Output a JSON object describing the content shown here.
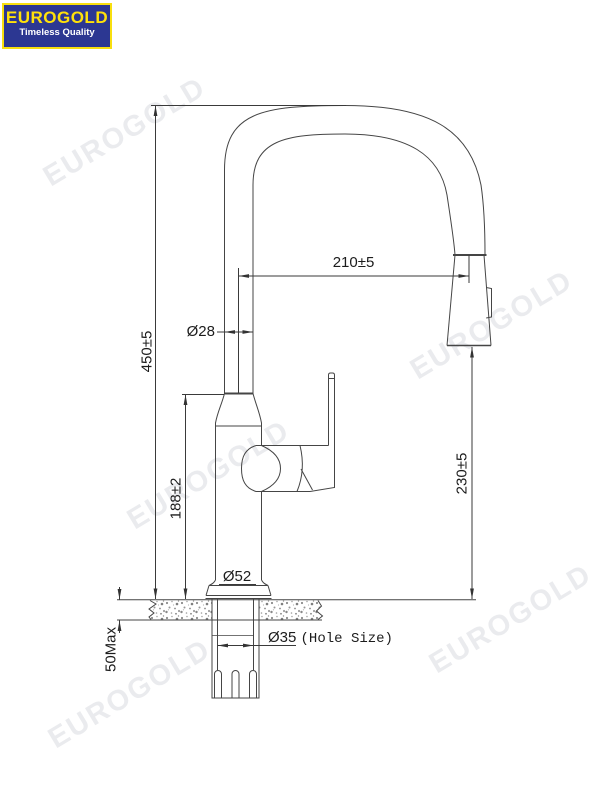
{
  "logo": {
    "brand": "EUROGOLD",
    "tagline": "Timeless Quality",
    "bg_color": "#2c3792",
    "border_color": "#f8df0e",
    "brand_color": "#ffe10a",
    "tagline_color": "#ffffff"
  },
  "watermark": {
    "text": "EUROGOLD",
    "color": "#e9eaee"
  },
  "drawing": {
    "type": "faucet-technical-drawing",
    "line_color": "#454545",
    "dimensions": {
      "spout_reach": "210±5",
      "spout_tube_diameter": "Ø28",
      "overall_height": "450±5",
      "body_height": "188±2",
      "spray_head_clearance": "230±5",
      "base_diameter": "Ø52",
      "hole_diameter": "Ø35",
      "hole_note": "(Hole Size)",
      "counter_thickness_max": "50Max"
    }
  }
}
